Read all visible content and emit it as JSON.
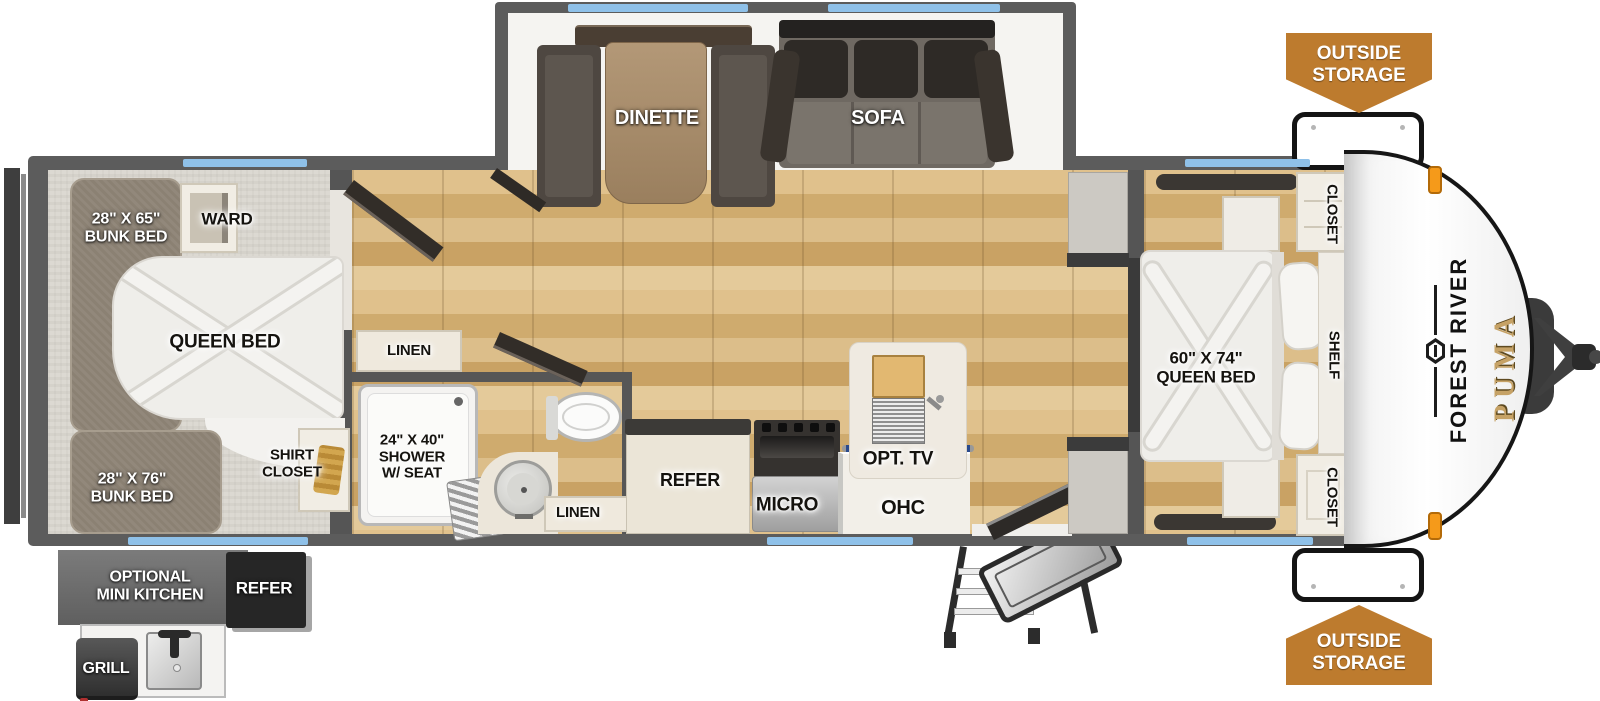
{
  "brand": {
    "manufacturer": "FOREST RIVER",
    "model": "PUMA"
  },
  "exterior": {
    "outside_storage_top": "OUTSIDE\nSTORAGE",
    "outside_storage_bottom": "OUTSIDE\nSTORAGE",
    "mini_kitchen_label": "OPTIONAL\nMINI KITCHEN",
    "mini_kitchen_refer": "REFER",
    "grill": "GRILL"
  },
  "slideout": {
    "dinette": "DINETTE",
    "sofa": "SOFA"
  },
  "bunk_room": {
    "bunk_top": "28\" X 65\"\nBUNK BED",
    "ward": "WARD",
    "queen_bed": "QUEEN BED",
    "bunk_bottom": "28\" X 76\"\nBUNK BED",
    "shirt_closet": "SHIRT\nCLOSET"
  },
  "bathroom": {
    "linen_upper": "LINEN",
    "shower": "24\" X 40\"\nSHOWER\nW/ SEAT",
    "linen_lower": "LINEN"
  },
  "kitchen": {
    "refer": "REFER",
    "micro": "MICRO",
    "ohc": "OHC",
    "opt_tv": "OPT. TV"
  },
  "bedroom": {
    "queen_bed": "60\" X 74\"\nQUEEN BED",
    "closet_upper": "CLOSET",
    "shelf": "SHELF",
    "closet_lower": "CLOSET"
  },
  "colors": {
    "badge_orange": "#bd7b2e",
    "window_blue": "#8fc1e9",
    "wall_gray": "#5c5c5c",
    "floor_wood": "#d9ba82",
    "puma_gold": "#c6a266"
  }
}
